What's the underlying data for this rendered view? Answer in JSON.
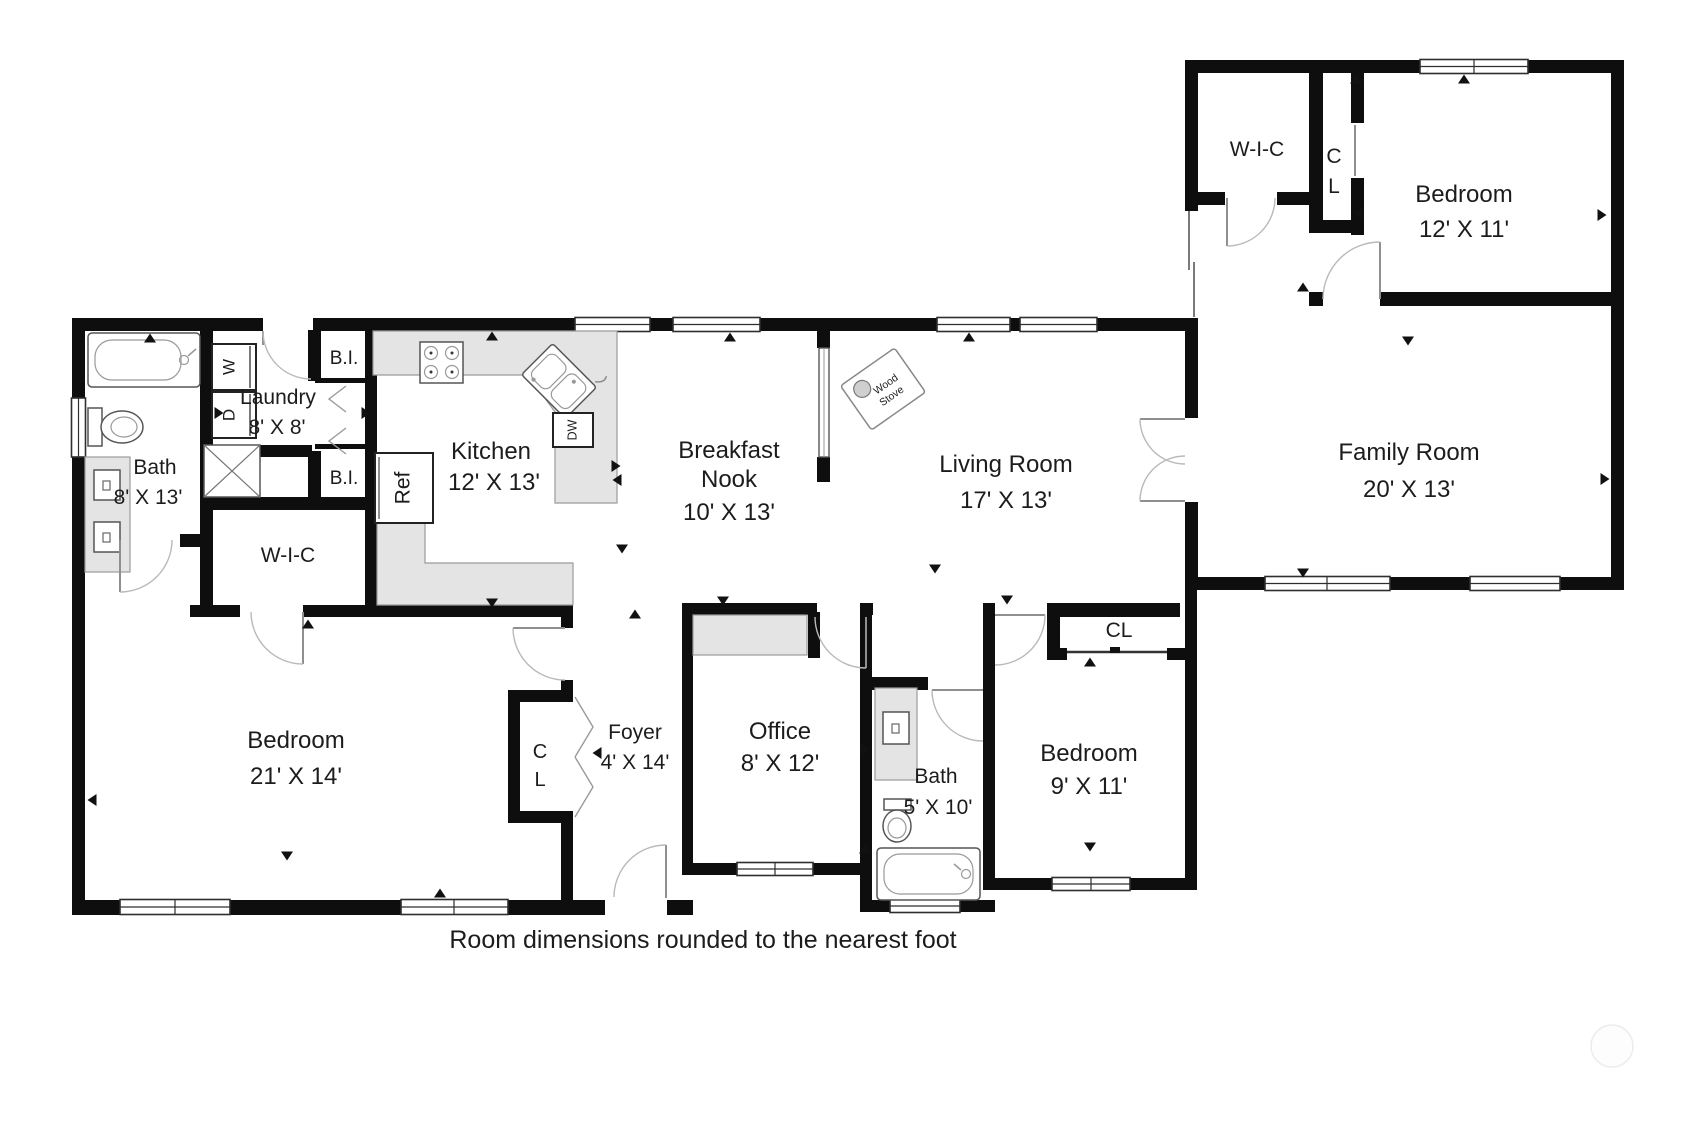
{
  "caption": "Room dimensions rounded to the nearest foot",
  "colors": {
    "wall": "#0e0e0e",
    "counter": "#e4e4e4",
    "text": "#1c1c1c",
    "background": "#ffffff"
  },
  "rooms": {
    "bedroom_wing": {
      "name": "Bedroom",
      "dims": "12' X 11'"
    },
    "wic_wing": {
      "name": "W-I-C"
    },
    "cl_wing": {
      "line1": "C",
      "line2": "L"
    },
    "family_room": {
      "name": "Family Room",
      "dims": "20' X 13'"
    },
    "laundry": {
      "name": "Laundry",
      "dims": "8' X 8'"
    },
    "bath_main": {
      "name": "Bath",
      "dims": "8' X 13'"
    },
    "kitchen": {
      "name": "Kitchen",
      "dims": "12' X 13'"
    },
    "breakfast_nook": {
      "line1": "Breakfast",
      "line2": "Nook",
      "dims": "10' X 13'"
    },
    "living_room": {
      "name": "Living Room",
      "dims": "17' X 13'"
    },
    "wic_main": {
      "name": "W-I-C"
    },
    "bedroom_master": {
      "name": "Bedroom",
      "dims": "21' X 14'"
    },
    "cl_foyer": {
      "line1": "C",
      "line2": "L"
    },
    "foyer": {
      "name": "Foyer",
      "dims": "4' X 14'"
    },
    "office": {
      "name": "Office",
      "dims": "8' X 12'"
    },
    "bath_small": {
      "name": "Bath",
      "dims": "5' X 10'"
    },
    "bedroom_small": {
      "name": "Bedroom",
      "dims": "9' X 11'"
    },
    "cl_small": {
      "name": "CL"
    },
    "bi_upper": {
      "name": "B.I."
    },
    "bi_lower": {
      "name": "B.I."
    }
  },
  "fixtures": {
    "washer": "W",
    "dryer": "D",
    "refrigerator": "Ref",
    "dishwasher": "DW",
    "wood_stove_line1": "Wood",
    "wood_stove_line2": "Stove"
  }
}
